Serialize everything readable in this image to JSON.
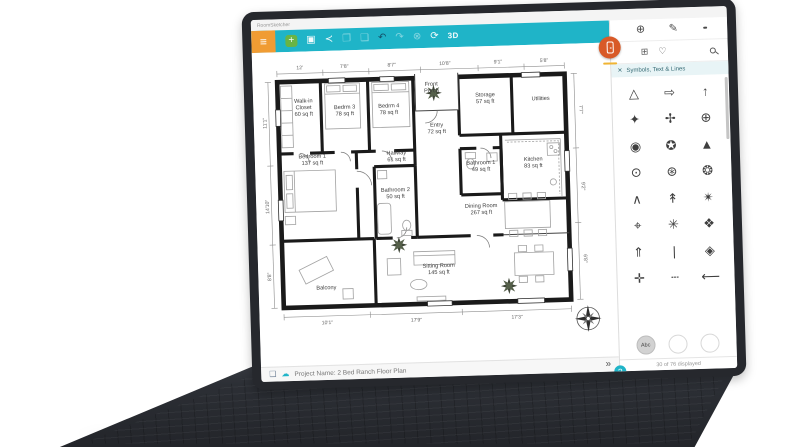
{
  "window": {
    "title": "RoomSketcher"
  },
  "toolbar": {
    "menu_icon": "≡",
    "icons": [
      {
        "name": "new-project",
        "glyph": "+",
        "cls": "green"
      },
      {
        "name": "save",
        "glyph": "▣",
        "cls": ""
      },
      {
        "name": "share",
        "glyph": "≺",
        "cls": ""
      },
      {
        "name": "copy",
        "glyph": "❐",
        "cls": "dim"
      },
      {
        "name": "paste",
        "glyph": "❏",
        "cls": "dim"
      },
      {
        "name": "undo",
        "glyph": "↶",
        "cls": "dark"
      },
      {
        "name": "redo",
        "glyph": "↷",
        "cls": "dim"
      },
      {
        "name": "delete",
        "glyph": "⊗",
        "cls": "dim"
      },
      {
        "name": "rotate",
        "glyph": "⟳",
        "cls": ""
      },
      {
        "name": "view-3d",
        "glyph": "3D",
        "cls": "bold"
      }
    ]
  },
  "sidebar": {
    "tabs": {
      "add": "⊕",
      "draw": "✎"
    },
    "categories": {
      "grid": "⊞",
      "favorites": "♡"
    },
    "panel_title": "Symbols, Text & Lines",
    "close_icon": "✕",
    "symbols": [
      {
        "name": "triangle-outline",
        "glyph": "△"
      },
      {
        "name": "arrow-right-outline",
        "glyph": "⇨"
      },
      {
        "name": "arrow-up-thin",
        "glyph": "↑"
      },
      {
        "name": "star-4-point",
        "glyph": "✦"
      },
      {
        "name": "compass-cross",
        "glyph": "✢"
      },
      {
        "name": "circle-cross",
        "glyph": "⊕"
      },
      {
        "name": "triangle-circle",
        "glyph": "◉"
      },
      {
        "name": "star-in-circle",
        "glyph": "✪"
      },
      {
        "name": "arrow-solid",
        "glyph": "▲"
      },
      {
        "name": "circle-arrow-1",
        "glyph": "⊙"
      },
      {
        "name": "circle-arrow-2",
        "glyph": "⊛"
      },
      {
        "name": "circle-arrow-3",
        "glyph": "❂"
      },
      {
        "name": "chevron-north",
        "glyph": "∧"
      },
      {
        "name": "needle-up",
        "glyph": "↟"
      },
      {
        "name": "radiant-star",
        "glyph": "✴"
      },
      {
        "name": "anchor-point",
        "glyph": "⌖"
      },
      {
        "name": "compass-rose",
        "glyph": "✳"
      },
      {
        "name": "compass-rose-detailed",
        "glyph": "❖"
      },
      {
        "name": "north-arrow",
        "glyph": "⇑"
      },
      {
        "name": "line-vertical",
        "glyph": "|"
      },
      {
        "name": "diamond-faded",
        "glyph": "◈"
      },
      {
        "name": "star-cross",
        "glyph": "✛"
      },
      {
        "name": "line-dashed",
        "glyph": "┄"
      },
      {
        "name": "line-arrow",
        "glyph": "⟵"
      }
    ],
    "bottom_buttons": [
      {
        "name": "text-abc",
        "label": "Abc",
        "selected": true
      },
      {
        "name": "circle-blank-1",
        "label": "",
        "selected": false
      },
      {
        "name": "circle-blank-2",
        "label": "",
        "selected": false
      }
    ],
    "footer": "30 of 76 displayed"
  },
  "statusbar": {
    "project": "Project Name: 2 Bed Ranch Floor Plan",
    "collapse": "»",
    "help": "?",
    "page_icon": "❑",
    "cloud_icon": "☁"
  },
  "floorplan": {
    "rooms": [
      {
        "lines": [
          "Walk-in",
          "Closet",
          "60 sq ft"
        ],
        "x": 45,
        "y": 52
      },
      {
        "lines": [
          "Bedrm 3",
          "78 sq ft"
        ],
        "x": 85,
        "y": 56
      },
      {
        "lines": [
          "Bedrm 4",
          "78 sq ft"
        ],
        "x": 128,
        "y": 56
      },
      {
        "lines": [
          "Front",
          "Porch"
        ],
        "x": 170,
        "y": 36
      },
      {
        "lines": [
          "Storage",
          "57 sq ft"
        ],
        "x": 222,
        "y": 48
      },
      {
        "lines": [
          "Utilities"
        ],
        "x": 276,
        "y": 50
      },
      {
        "lines": [
          "Bedroom 1",
          "137 sq ft"
        ],
        "x": 52,
        "y": 103
      },
      {
        "lines": [
          "Entry",
          "72 sq ft"
        ],
        "x": 174,
        "y": 76
      },
      {
        "lines": [
          "Hallway",
          "61 sq ft"
        ],
        "x": 134,
        "y": 102
      },
      {
        "lines": [
          "Bathroom 1",
          "49 sq ft"
        ],
        "x": 216,
        "y": 114
      },
      {
        "lines": [
          "Kitchen",
          "83 sq ft"
        ],
        "x": 267,
        "y": 112
      },
      {
        "lines": [
          "Bathroom 2",
          "50 sq ft"
        ],
        "x": 132,
        "y": 138
      },
      {
        "lines": [
          "Dining Room",
          "267 sq ft"
        ],
        "x": 215,
        "y": 156
      },
      {
        "lines": [
          "Sitting Room",
          "145 sq ft"
        ],
        "x": 172,
        "y": 213
      },
      {
        "lines": [
          "Balcony"
        ],
        "x": 62,
        "y": 228
      }
    ],
    "dimensions": {
      "top": [
        {
          "label": "12'",
          "f": 0.08
        },
        {
          "label": "7'8\"",
          "f": 0.235
        },
        {
          "label": "8'7\"",
          "f": 0.4
        },
        {
          "label": "10'8\"",
          "f": 0.585
        },
        {
          "label": "9'1\"",
          "f": 0.77
        },
        {
          "label": "5'8\"",
          "f": 0.93
        }
      ],
      "left": [
        {
          "label": "11'1\"",
          "f": 0.18
        },
        {
          "label": "14'10\"",
          "f": 0.55
        },
        {
          "label": "8'8\"",
          "f": 0.86
        }
      ],
      "bottom": [
        {
          "label": "10'1\"",
          "f": 0.15
        },
        {
          "label": "17'9\"",
          "f": 0.46
        },
        {
          "label": "17'3\"",
          "f": 0.81
        }
      ],
      "right": [
        {
          "label": "7'7\"",
          "f": 0.16
        },
        {
          "label": "9'2\"",
          "f": 0.5
        },
        {
          "label": "6'8\"",
          "f": 0.82
        }
      ]
    }
  },
  "colors": {
    "teal": "#1fb4c8",
    "orange": "#f09c33",
    "badge": "#d85a28"
  }
}
